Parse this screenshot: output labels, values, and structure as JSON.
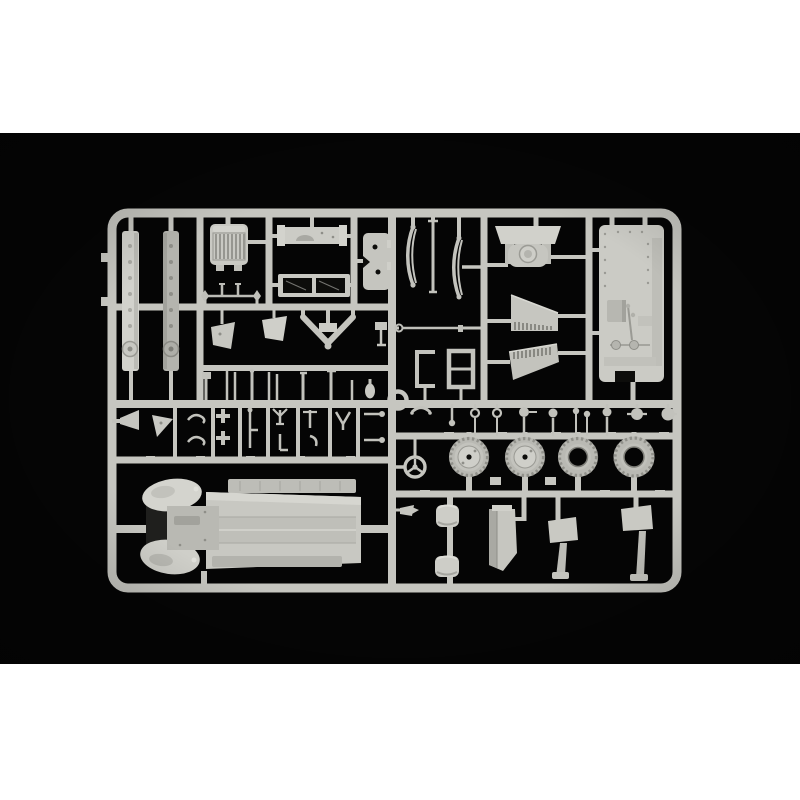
{
  "image": {
    "type": "product-photo",
    "subject": "Injection-moulded light grey plastic model kit sprue (parts tree) for a military truck kit, photographed on a black background centred on a white product-page canvas",
    "text_visible": "none"
  },
  "colors": {
    "page_background": "#ffffff",
    "photo_background": "#050505",
    "sprue_base": "#c6c6c0",
    "sprue_light": "#d4d4ce",
    "sprue_lighter": "#dcdcd6",
    "sprue_mid": "#b9b9b3",
    "sprue_dark": "#96968f",
    "sprue_deep": "#82827c",
    "hole_dark": "#0d0d0b",
    "shadow_pocket": "#1f1f1d"
  },
  "parts": {
    "frame": "rectangular sprue frame with rounded corners and internal runner grid",
    "items": [
      {
        "name": "chassis-rail-a",
        "desc": "long chassis side rail with rivet holes and round boss"
      },
      {
        "name": "chassis-rail-b",
        "desc": "second chassis side rail, darker shading"
      },
      {
        "name": "radiator-grille",
        "desc": "radiator shell with vertical slats"
      },
      {
        "name": "dashboard-panel",
        "desc": "narrow panel with curved instrument recess"
      },
      {
        "name": "windscreen-frame",
        "desc": "two-pane windscreen frame with open glazing"
      },
      {
        "name": "door-panel",
        "desc": "small door / hatch panel with two holes"
      },
      {
        "name": "front-axle",
        "desc": "axle rod with kingpin ends"
      },
      {
        "name": "mudflap-a",
        "desc": "small trapezoid flap on stem"
      },
      {
        "name": "mudflap-b",
        "desc": "small trapezoid flap on stem"
      },
      {
        "name": "tow-bar",
        "desc": "V-shaped tow bar with ball end"
      },
      {
        "name": "lever-set",
        "desc": "row of small levers and linkages"
      },
      {
        "name": "small-fittings-grid",
        "desc": "grid of hooks, clamps and brackets"
      },
      {
        "name": "moulding-ring",
        "desc": "small circular ring at runner junction"
      },
      {
        "name": "leaf-springs",
        "desc": "curved leaf springs and torque rod"
      },
      {
        "name": "link-rod",
        "desc": "thin steering link rod with eyelet"
      },
      {
        "name": "chassis-clips",
        "desc": "two U-channel brackets"
      },
      {
        "name": "fuel-tank",
        "desc": "fuel tank with filler cap and mounting straps"
      },
      {
        "name": "louvre-panel-a",
        "desc": "engine side panel with louvres"
      },
      {
        "name": "louvre-panel-b",
        "desc": "mirrored engine side panel with louvres"
      },
      {
        "name": "cab-floor-panel",
        "desc": "large cab floor with gearbox hump, levers and pedals"
      },
      {
        "name": "fittings-row",
        "desc": "row of knobs, eyelets, lamps and horns"
      },
      {
        "name": "steering-wheel",
        "desc": "three-spoke steering wheel"
      },
      {
        "name": "road-wheel-a",
        "desc": "complete road wheel with hub"
      },
      {
        "name": "road-wheel-b",
        "desc": "complete road wheel with hub"
      },
      {
        "name": "spare-tyre-a",
        "desc": "open-centre spare tyre"
      },
      {
        "name": "spare-tyre-b",
        "desc": "open-centre spare tyre"
      },
      {
        "name": "seat-cushion-a",
        "desc": "curved seat cushion"
      },
      {
        "name": "seat-cushion-b",
        "desc": "curved seat cushion"
      },
      {
        "name": "pointer-bracket",
        "desc": "small arrow-shaped bracket"
      },
      {
        "name": "mudguard",
        "desc": "folded front mudguard panel"
      },
      {
        "name": "support-bracket-a",
        "desc": "stepped support bracket with blade"
      },
      {
        "name": "support-bracket-b",
        "desc": "stepped support bracket with blade"
      },
      {
        "name": "truck-body",
        "desc": "one-piece bonnet, fenders and flat cargo-bed body"
      }
    ]
  }
}
